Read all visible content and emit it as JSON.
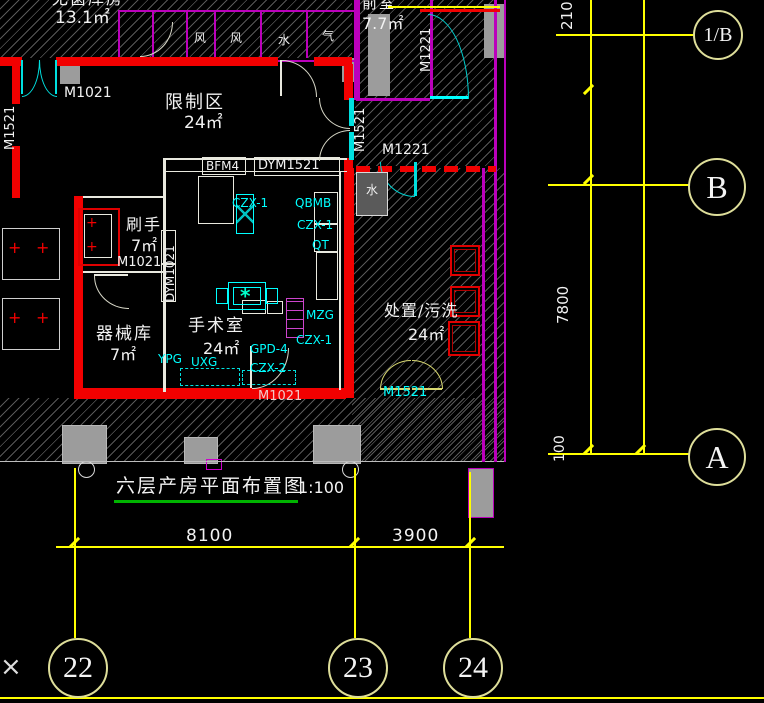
{
  "drawing": {
    "title": "六层产房平面布置图",
    "scale": "1:100",
    "rooms": {
      "sterile_store": {
        "name": "无菌库房",
        "area": "13.1㎡"
      },
      "restricted": {
        "name": "限制区",
        "area": "24㎡"
      },
      "scrub": {
        "name": "刷手",
        "area": "7㎡"
      },
      "instrument": {
        "name": "器械库",
        "area": "7㎡"
      },
      "operating": {
        "name": "手术室",
        "area": "24㎡"
      },
      "disposal": {
        "name": "处置/污洗",
        "area": "24㎡"
      },
      "anteroom": {
        "name": "前室",
        "area": "7.7㎡"
      }
    },
    "shafts": {
      "s1": "风",
      "s2": "风",
      "s3": "水",
      "s4": "气",
      "s5": "水"
    },
    "doors": {
      "m1021_top": "M1021",
      "m1521_left": "M1521",
      "m1521_right": "M1521",
      "m1221_v": "M1221",
      "m1221_h": "M1221",
      "bfm4": "BFM4",
      "dym1521": "DYM1521",
      "dym1021": "DYM1021",
      "m1021_scrub": "M1021",
      "m1021_or": "M1021",
      "m1521_bottom": "M1521"
    },
    "equipment": {
      "czx1_a": "CZX-1",
      "qbmb": "QBMB",
      "czx1_b": "CZX-1",
      "qt": "QT",
      "mzg": "MZG",
      "czx1_c": "CZX-1",
      "gpd4": "GPD-4",
      "czx2": "CZX-2",
      "ypg": "YPG",
      "uxg": "UXG"
    },
    "dimensions": {
      "d210": "210",
      "d7800": "7800",
      "d100": "100",
      "d8100": "8100",
      "d3900": "3900"
    },
    "grid_bubbles": {
      "b1b": "1/B",
      "b": "B",
      "a": "A",
      "n22": "22",
      "n23": "23",
      "n24": "24"
    },
    "misc": {
      "cross": "×",
      "table_star": "*"
    }
  },
  "colors": {
    "wall_red": "#f20000",
    "line_magenta": "#bb00bb",
    "line_cyan": "#00ffff",
    "line_yellow": "#ffff00",
    "bubble_stroke": "#dede9a",
    "text_white": "#f2f2f2",
    "hatch_gray": "#a0a0a0",
    "underline_green": "#00b400",
    "fill_gray": "#9c9c9c"
  }
}
